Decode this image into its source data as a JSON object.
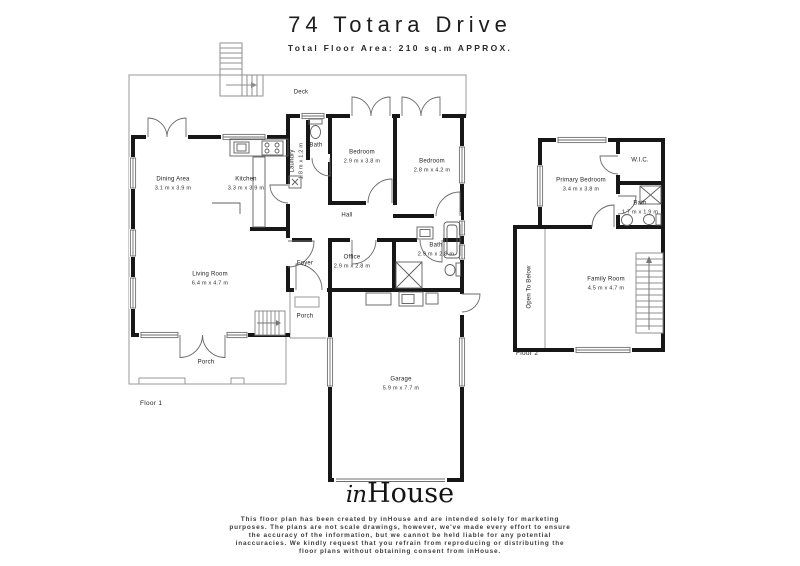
{
  "header": {
    "title": "74 Totara Drive",
    "subtitle": "Total Floor Area: 210 sq.m APPROX."
  },
  "floor1": {
    "label": "Floor 1",
    "rooms": [
      {
        "name": "Deck",
        "dims": ""
      },
      {
        "name": "Bath",
        "dims": ""
      },
      {
        "name": "Laundry",
        "dims": "1.8 m x 1.2 m"
      },
      {
        "name": "Bedroom",
        "dims": "2.9 m x 3.8 m"
      },
      {
        "name": "Bedroom",
        "dims": "2.8 m x 4.2 m"
      },
      {
        "name": "Dining Area",
        "dims": "3.1 m x 3.9 m"
      },
      {
        "name": "Kitchen",
        "dims": "3.3 m x 3.9 m"
      },
      {
        "name": "Hall",
        "dims": ""
      },
      {
        "name": "Living Room",
        "dims": "6.4 m x 4.7 m"
      },
      {
        "name": "Office",
        "dims": "2.9 m x 2.8 m"
      },
      {
        "name": "Bath",
        "dims": "2.9 m x 2.8 m"
      },
      {
        "name": "Foyer",
        "dims": ""
      },
      {
        "name": "Porch",
        "dims": ""
      },
      {
        "name": "Porch",
        "dims": ""
      },
      {
        "name": "Garage",
        "dims": "5.9 m x 7.7 m"
      }
    ]
  },
  "floor2": {
    "label": "Floor 2",
    "rooms": [
      {
        "name": "Primary Bedroom",
        "dims": "3.4 m x 3.8 m"
      },
      {
        "name": "W.I.C.",
        "dims": ""
      },
      {
        "name": "Bath",
        "dims": "1.7 m x 1.9 m"
      },
      {
        "name": "Open To Below",
        "dims": ""
      },
      {
        "name": "Family Room",
        "dims": "4.5 m x 4.7 m"
      }
    ]
  },
  "footer": {
    "logo_script": "in",
    "logo_serif": "House",
    "disclaimer": [
      "This floor plan has been created by inHouse and are intended solely for marketing",
      "purposes. The plans are not scale drawings, however, we've made every effort to ensure",
      "the accuracy of the information, but we cannot be held liable for any potential",
      "inaccuracies. We kindly request that you refrain from reproducing or distributing the",
      "floor plans without obtaining consent from inHouse."
    ]
  },
  "colors": {
    "wall": "#171717",
    "thin_line": "#9a9a9a",
    "text": "#222222"
  }
}
